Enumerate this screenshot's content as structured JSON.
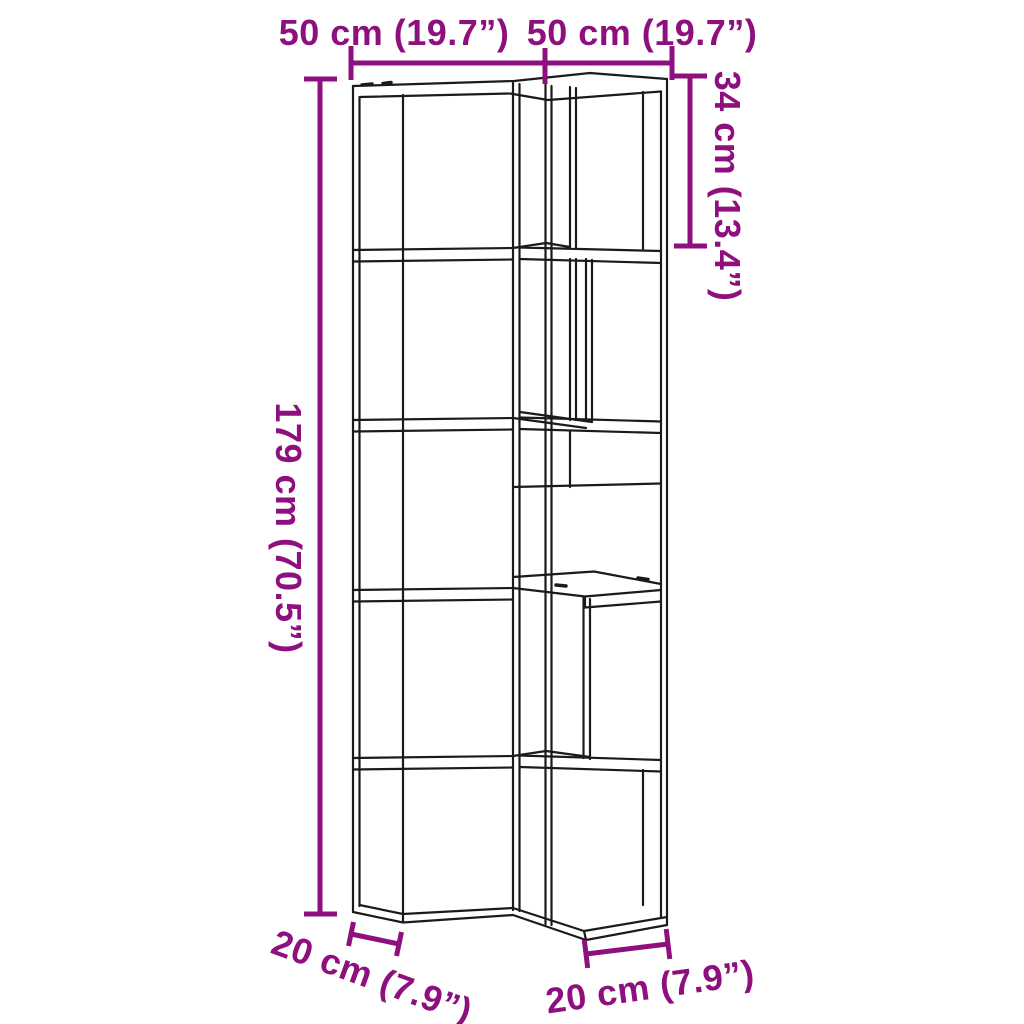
{
  "diagram": {
    "kind": "product-dimension-diagram",
    "shelf_tiers": 5,
    "colors": {
      "dimension_accent": "#8E107F",
      "drawing_outline": "#1b1b1b",
      "background": "#ffffff"
    },
    "dimensions": {
      "top_left_width": {
        "label": "50 cm (19.7”)"
      },
      "top_right_width": {
        "label": "50 cm (19.7”)"
      },
      "overall_height": {
        "label": "179 cm (70.5”)"
      },
      "top_tier_height": {
        "label": "34 cm (13.4”)"
      },
      "bottom_left_depth": {
        "label": "20 cm (7.9”)"
      },
      "bottom_right_depth": {
        "label": "20 cm (7.9”)"
      }
    }
  }
}
